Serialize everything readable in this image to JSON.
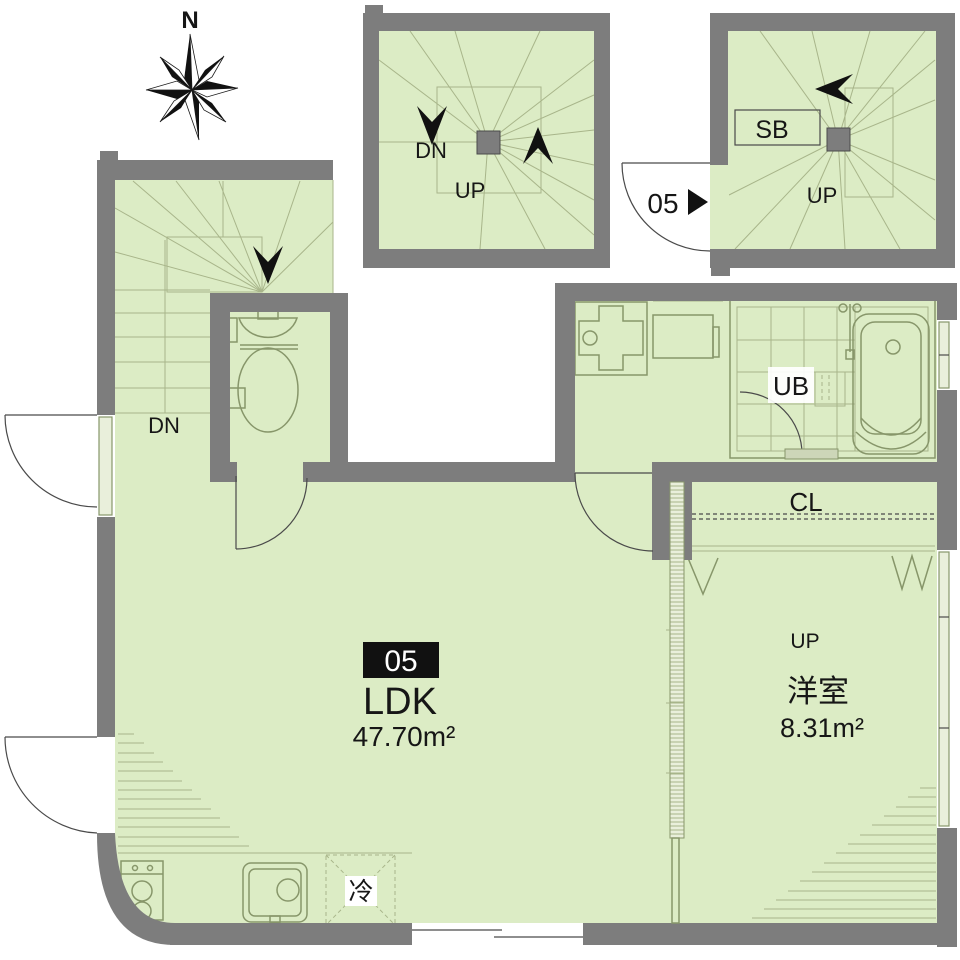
{
  "colors": {
    "floor": "#dcecc5",
    "wall": "#7d7d7d",
    "line": "#87966a",
    "tile": "#a8b58a",
    "dark": "#161616",
    "window": "#e9efdb"
  },
  "compass": {
    "north": "N"
  },
  "upper_stairwell": {
    "down": "DN",
    "up": "UP"
  },
  "entry_stairwell": {
    "shoe_box": "SB",
    "up": "UP",
    "unit_door": "05"
  },
  "internal_stair": {
    "down": "DN"
  },
  "ldk": {
    "unit_number": "05",
    "label": "LDK",
    "area": "47.70m²"
  },
  "bedroom": {
    "label": "洋室",
    "area": "8.31m²",
    "up": "UP"
  },
  "closet": {
    "label": "CL"
  },
  "unit_bath": {
    "label": "UB"
  },
  "kitchen": {
    "fridge": "冷"
  }
}
